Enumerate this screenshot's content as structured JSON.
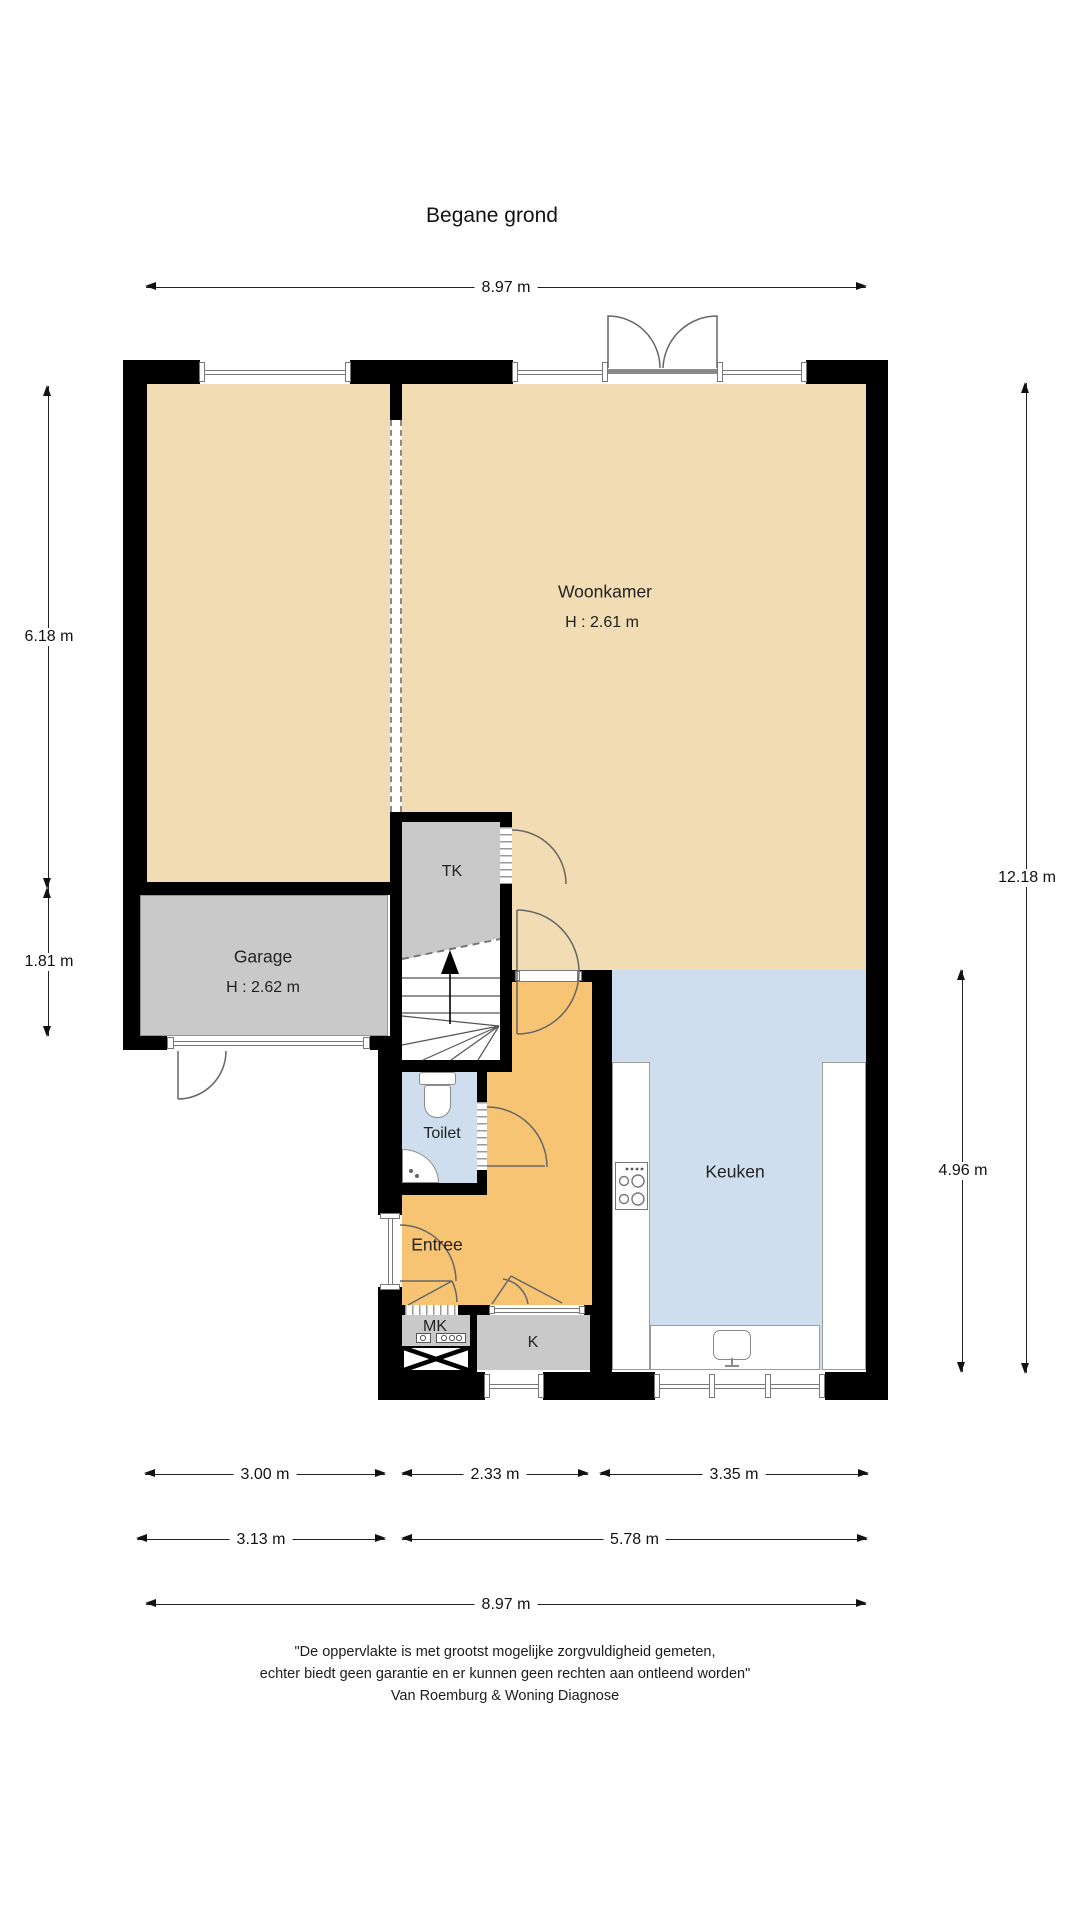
{
  "title": "Begane grond",
  "rooms": {
    "woonkamer": {
      "name": "Woonkamer",
      "height": "H : 2.61 m"
    },
    "garage": {
      "name": "Garage",
      "height": "H : 2.62 m"
    },
    "tk": "TK",
    "toilet": "Toilet",
    "entree": "Entree",
    "mk": "MK",
    "k": "K",
    "keuken": "Keuken"
  },
  "dims": {
    "top_width": "8.97 m",
    "left_upper": "6.18 m",
    "left_lower": "1.81 m",
    "right_total": "12.18 m",
    "right_kitchen": "4.96 m",
    "bottom_row1": [
      "3.00 m",
      "2.33 m",
      "3.35 m"
    ],
    "bottom_row2": [
      "3.13 m",
      "5.78 m"
    ],
    "bottom_total": "8.97 m"
  },
  "disclaimer": {
    "line1": "\"De oppervlakte is met grootst mogelijke zorgvuldigheid gemeten,",
    "line2": "echter biedt geen garantie en er kunnen geen rechten aan ontleend worden\"",
    "line3": "Van Roemburg & Woning Diagnose"
  },
  "colors": {
    "floor_tan": "#f2dcb3",
    "floor_orange": "#f6c472",
    "floor_blue": "#cfdeee",
    "floor_gray": "#c9c9c9",
    "wall": "#000000"
  }
}
